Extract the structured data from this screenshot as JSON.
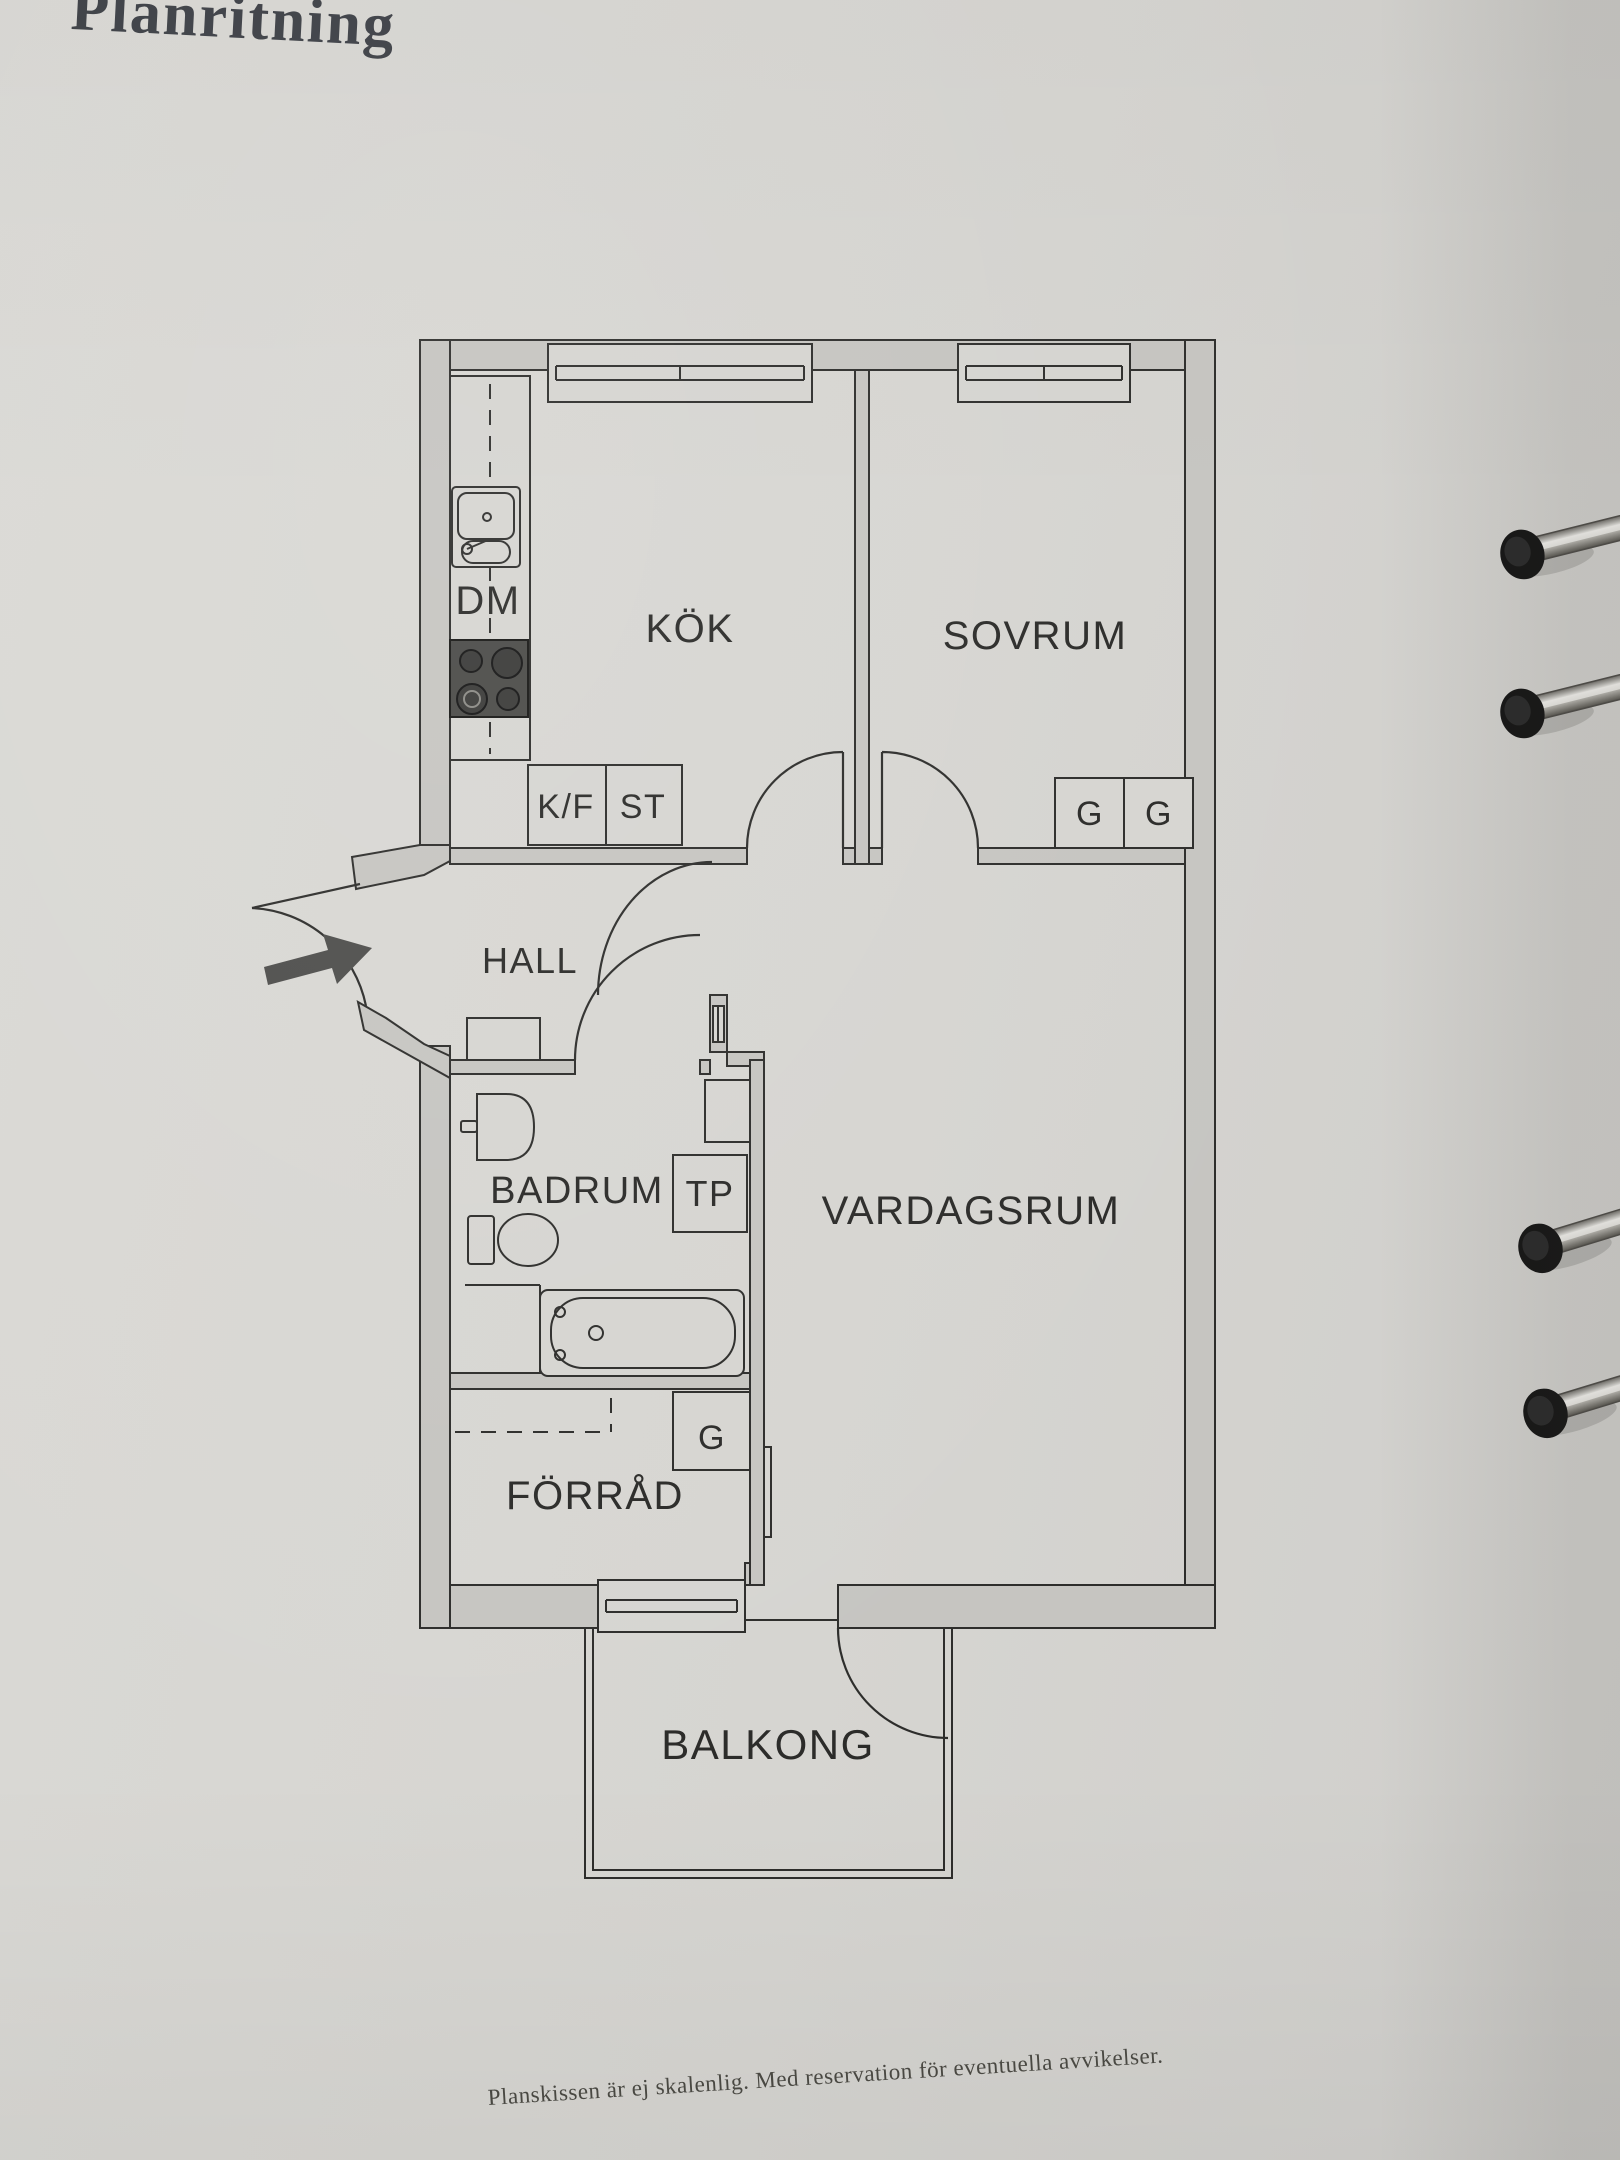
{
  "page": {
    "title": "Planritning",
    "caption": "Planskissen är ej skalenlig. Med reservation för eventuella avvikelser."
  },
  "floorplan": {
    "rooms": [
      {
        "label": "KÖK"
      },
      {
        "label": "SOVRUM"
      },
      {
        "label": "HALL"
      },
      {
        "label": "BADRUM"
      },
      {
        "label": "VARDAGSRUM"
      },
      {
        "label": "FÖRRÅD"
      },
      {
        "label": "BALKONG"
      }
    ],
    "labels": {
      "dishwasher": "DM",
      "fridge_freezer": "K/F",
      "st": "ST",
      "wardrobe": "G",
      "tp": "TP"
    },
    "binder_rings_count": 4
  },
  "colors": {
    "page_bg": "#d6d5d1",
    "wall_fill": "#c6c5c1",
    "line": "#2d2d2b",
    "text": "#2b2b29",
    "stove_fill": "#4a4a47",
    "arrow_fill": "#4e4e4c"
  }
}
